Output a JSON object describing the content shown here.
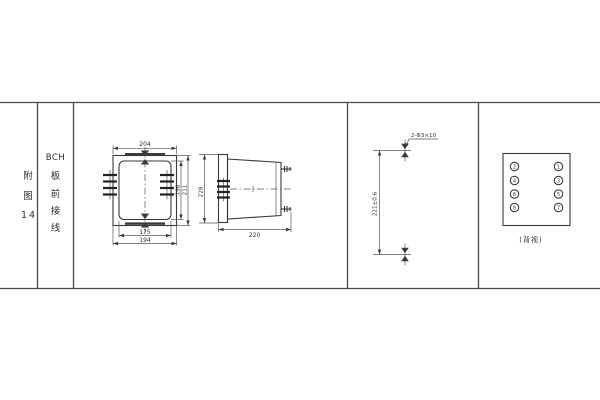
{
  "figure_label": {
    "char1": "附",
    "char2": "图",
    "num": "14"
  },
  "figure_title": {
    "latin": "BCH",
    "chars": [
      "板",
      "前",
      "接",
      "线"
    ]
  },
  "front_view": {
    "dim_width": "204",
    "dim_inner_height": "196",
    "dim_outer_height": "211",
    "dim_total_height": "228",
    "dim_inner_width": "175",
    "dim_outer_width": "194"
  },
  "side_view": {
    "dim_depth": "220"
  },
  "drill_view": {
    "hole_note": "2-Φ3×10",
    "dim_hole_spacing": "221±0.6"
  },
  "rear_view": {
    "caption": "(背视)",
    "terminals_left": [
      "2",
      "4",
      "6",
      "8"
    ],
    "terminals_right": [
      "1",
      "3",
      "5",
      "7"
    ]
  },
  "colors": {
    "line": "#3a3a3a",
    "background": "#ffffff"
  }
}
